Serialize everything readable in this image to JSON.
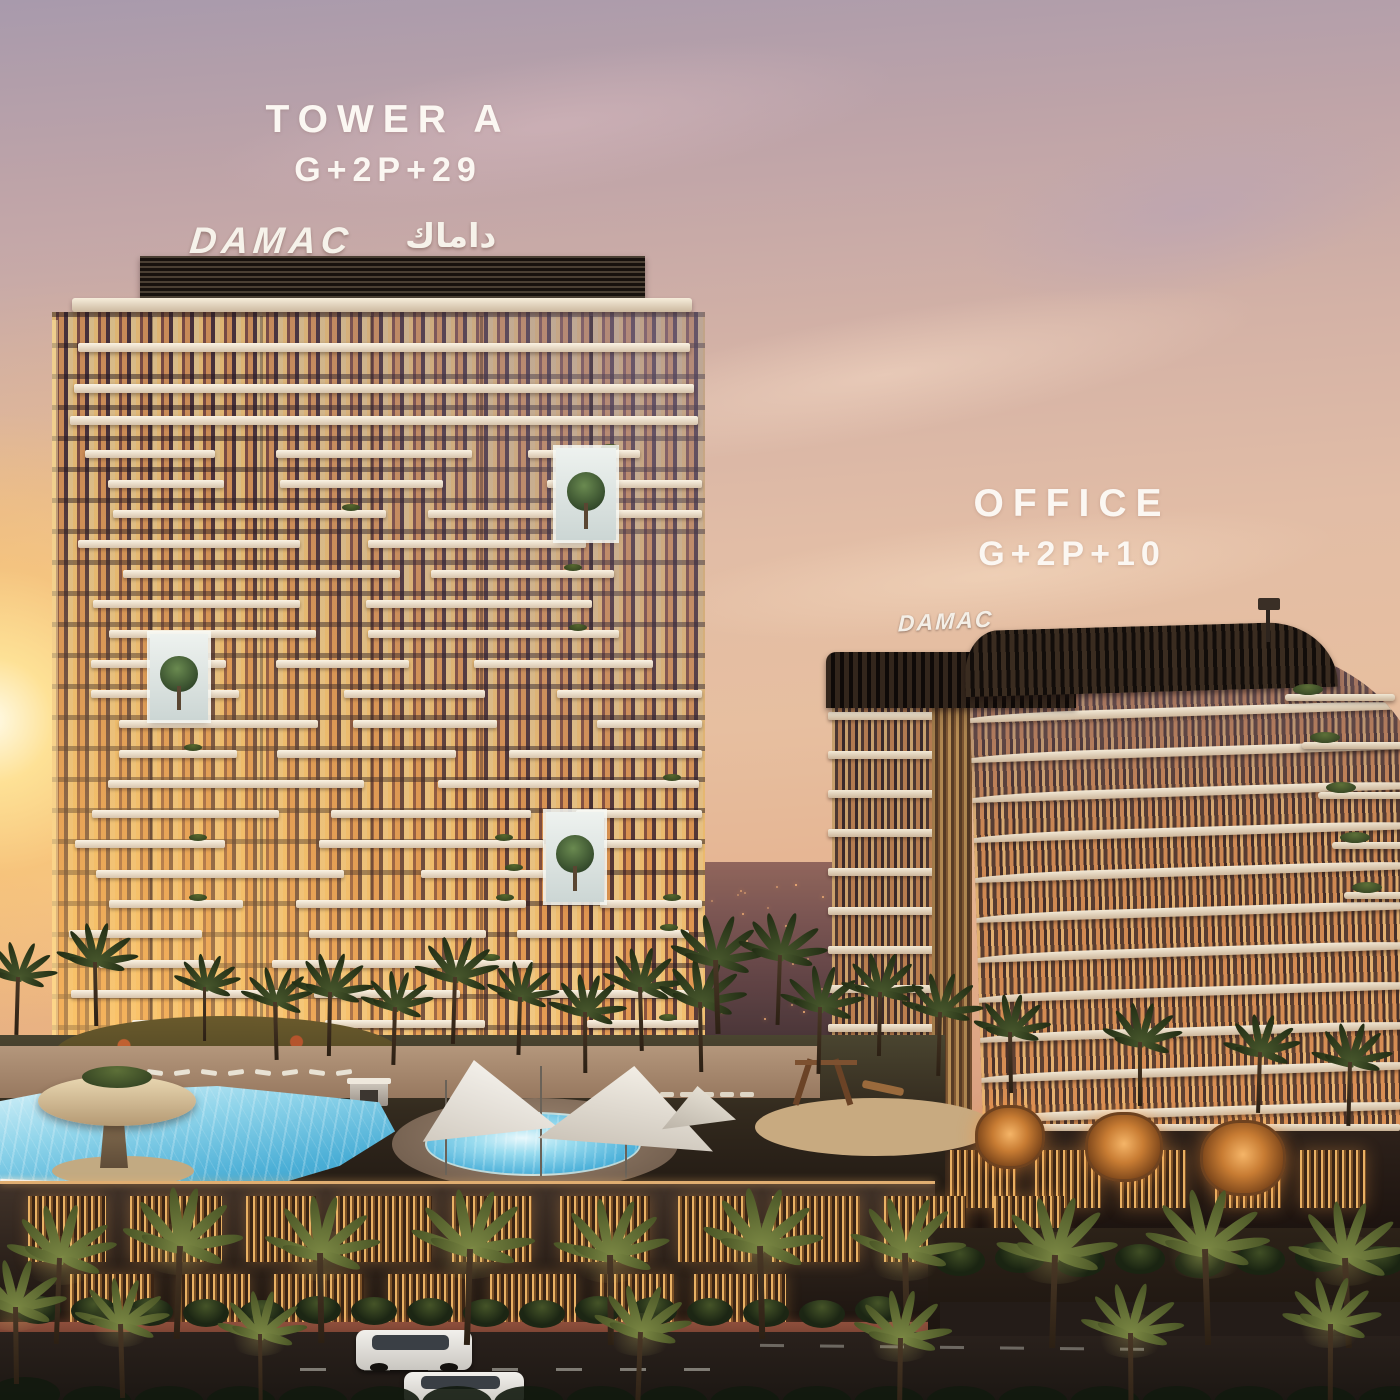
{
  "meta": {
    "scene_type": "architectural-sunset-render",
    "description": "DAMAC residential tower and office building with resort pools at dusk"
  },
  "labels": {
    "tower_a": {
      "line1": "TOWER A",
      "line2": "G+2P+29"
    },
    "office": {
      "line1": "OFFICE",
      "line2": "G+2P+10"
    }
  },
  "signs": {
    "tower_brand_latin": "DAMAC",
    "tower_brand_arabic": "داماك",
    "office_brand": "DAMAC"
  },
  "colors": {
    "sky_top": "#a89aac",
    "sky_mid": "#e2bda6",
    "sky_horizon": "#c08673",
    "sun_core": "#fffbe8",
    "sun_glow": "#f9c878",
    "slab_light": "#fbf3e3",
    "slab_shade": "#d6c3ab",
    "glass_warm": "#e8a45c",
    "glass_dark": "#4a3540",
    "crown_dark": "#17110d",
    "pool_blue": "#4aaed6",
    "podium_glow": "#e9b164",
    "palm_dark": "#3d4d26",
    "palm_lit": "#7d8a45"
  },
  "scene": {
    "tower_a": {
      "visible_floor_bands": 20,
      "body": [
        52,
        312,
        653,
        746
      ],
      "feature_boxes": [
        [
          556,
          448,
          60,
          92
        ],
        [
          150,
          634,
          58,
          86
        ],
        [
          546,
          812,
          58,
          90
        ]
      ]
    },
    "office": {
      "floor_bands": 11,
      "left_face": [
        832,
        700,
        100,
        440
      ],
      "curved_face": [
        968,
        652,
        450,
        486
      ],
      "terraces": [
        [
          1285,
          694,
          110
        ],
        [
          1302,
          742,
          102
        ],
        [
          1318,
          792,
          96
        ],
        [
          1332,
          842,
          90
        ],
        [
          1344,
          892,
          84
        ]
      ]
    },
    "pools": {
      "main": [
        0,
        1086,
        395,
        108
      ],
      "oval": [
        425,
        1112,
        212,
        60
      ],
      "oval_deck": [
        392,
        1098,
        286,
        92
      ],
      "fountain": [
        38,
        1076,
        158,
        50
      ]
    },
    "palms": {
      "garden": [
        [
          18,
          975,
          0.9
        ],
        [
          95,
          960,
          1.0
        ],
        [
          205,
          985,
          0.85
        ],
        [
          275,
          1000,
          0.9
        ],
        [
          330,
          990,
          1.0
        ],
        [
          395,
          1005,
          0.9
        ],
        [
          455,
          975,
          1.05
        ],
        [
          520,
          995,
          0.9
        ],
        [
          585,
          1010,
          0.95
        ],
        [
          640,
          985,
          1.0
        ],
        [
          700,
          1000,
          1.1
        ],
        [
          715,
          958,
          1.15
        ],
        [
          780,
          953,
          1.1
        ],
        [
          820,
          1005,
          1.05
        ],
        [
          880,
          990,
          1.0
        ],
        [
          940,
          1010,
          1.0
        ],
        [
          1010,
          1030,
          0.95
        ],
        [
          1140,
          1040,
          1.0
        ],
        [
          1260,
          1050,
          0.95
        ],
        [
          1350,
          1060,
          1.0
        ]
      ],
      "street": [
        [
          60,
          1255,
          1.35
        ],
        [
          180,
          1243,
          1.45
        ],
        [
          320,
          1250,
          1.4
        ],
        [
          470,
          1246,
          1.5
        ],
        [
          610,
          1252,
          1.4
        ],
        [
          760,
          1243,
          1.45
        ],
        [
          905,
          1250,
          1.4
        ],
        [
          1055,
          1252,
          1.45
        ],
        [
          1205,
          1246,
          1.5
        ],
        [
          1345,
          1255,
          1.4
        ],
        [
          15,
          1305,
          1.2
        ],
        [
          120,
          1322,
          1.15
        ],
        [
          260,
          1332,
          1.1
        ],
        [
          640,
          1330,
          1.2
        ],
        [
          900,
          1336,
          1.2
        ],
        [
          1130,
          1330,
          1.25
        ],
        [
          1330,
          1322,
          1.2
        ]
      ]
    },
    "egg_pods": [
      [
        975,
        1105,
        64,
        58
      ],
      [
        1085,
        1112,
        72,
        64
      ],
      [
        1200,
        1120,
        80,
        70
      ]
    ],
    "cabanas": [
      [
        165,
        1092
      ],
      [
        230,
        1098
      ],
      [
        350,
        1082
      ]
    ],
    "podium_window_rows": {
      "row1": {
        "y": 1196,
        "h": 66,
        "x_start": 28,
        "widths": [
          78,
          92,
          70,
          96,
          80,
          90,
          74,
          88,
          82,
          70
        ]
      },
      "row2": {
        "y": 1274,
        "h": 52,
        "x_start": 70,
        "widths": [
          84,
          72,
          90,
          78,
          86,
          74,
          92
        ]
      }
    },
    "office_base_slats": [
      950,
      1035,
      1120,
      1215,
      1300
    ],
    "cars": [
      [
        356,
        1330,
        116,
        40
      ],
      [
        404,
        1372,
        120,
        34
      ]
    ]
  }
}
